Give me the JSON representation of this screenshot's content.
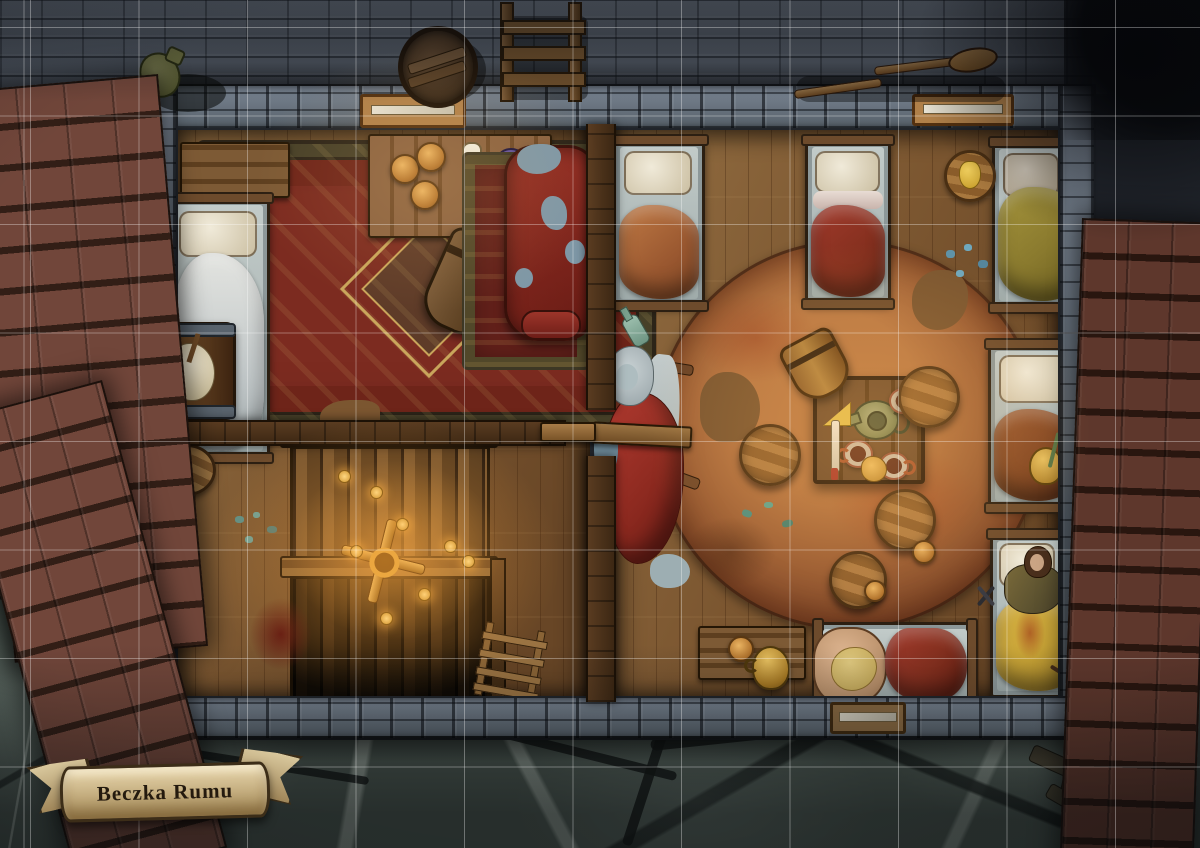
{
  "map": {
    "title": "Beczka Rumu",
    "kind": "tavern-upper-floor-battlemap",
    "grid": {
      "cell_size_px": 108.5,
      "offset_x_px": 30,
      "offset_y_px": 28,
      "line_color": "#ffffff",
      "line_opacity": 0.33,
      "columns": 11,
      "rows": 8
    }
  },
  "palette": {
    "floor_wood": "#7b5630",
    "stone_wall": "#6b7582",
    "street_brick": "#555d68",
    "flagstone": "#46514b",
    "roof_shingle_left": "#71463a",
    "roof_shingle_right": "#5e372c",
    "carpet_red": "#7c2b20",
    "round_rug": "#9a5c33",
    "couch_red": "#8f2b22",
    "blanket_orange": "#b06a3a",
    "blanket_red": "#8e3026",
    "blanket_olive": "#8a7a2e",
    "blanket_rust": "#8a4a28",
    "blanket_yellow": "#c9a436",
    "banner_parchment": "#d3c194",
    "banner_text": "#241a0e",
    "glow_warm": "#ffb14a",
    "coin_gold": "#e8b05c"
  },
  "objects": [
    "barrel-lid",
    "ladder",
    "oar",
    "spilled-jug",
    "window",
    "bench",
    "bed",
    "pillow",
    "blanket",
    "ornate-carpet",
    "round-rug",
    "couch",
    "table",
    "tankard",
    "mug",
    "teapot",
    "cheese-wedge",
    "knife",
    "scroll",
    "purple-plate",
    "fallen-stool",
    "mop-barrel",
    "staircase",
    "gold-coins",
    "candelabra",
    "blood-stain",
    "herb-scatter",
    "broken-chair",
    "bottle",
    "sleeping-elder-token",
    "resting-woman-token",
    "straw-sack",
    "smoking-pipe",
    "stool",
    "jug",
    "banner-ribbon"
  ]
}
